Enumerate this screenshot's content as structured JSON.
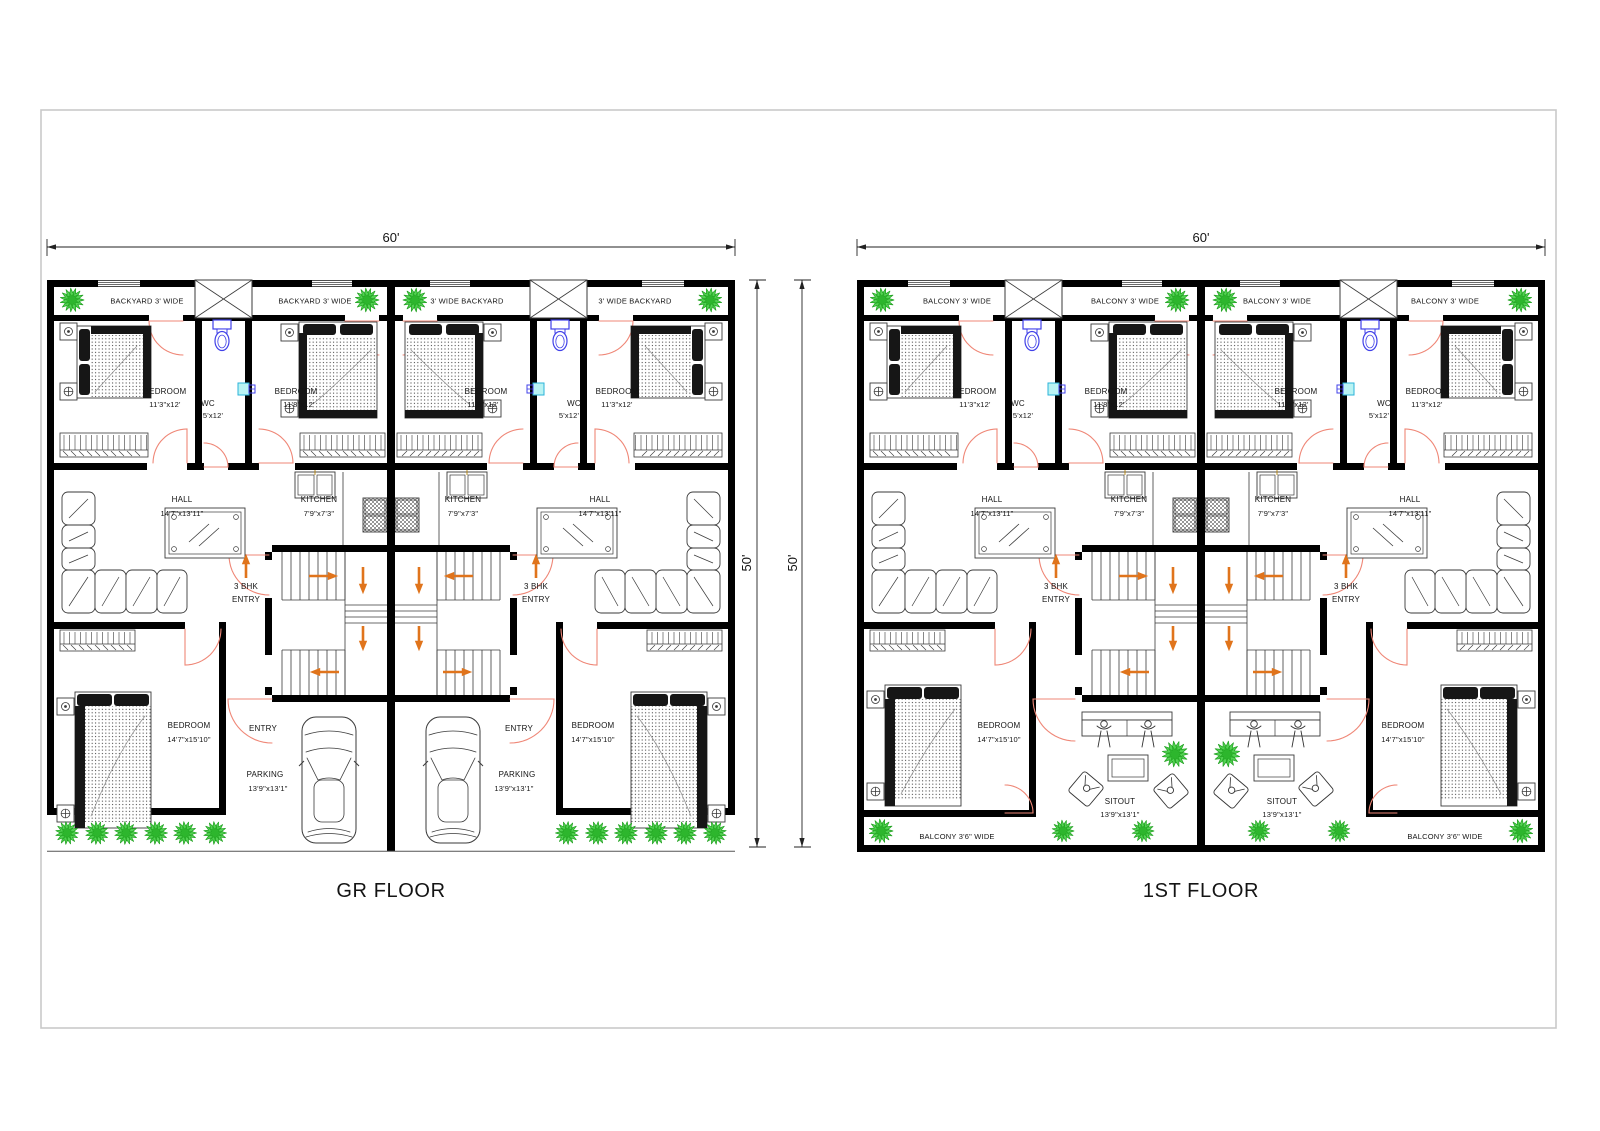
{
  "page": {
    "bg": "#ffffff",
    "frame_color": "#c9c9c9"
  },
  "colors": {
    "wall": "#000000",
    "line": "#3a3a3a",
    "door": "#ef8777",
    "arrow": "#e0741c",
    "plant": "#53d253",
    "plant_dark": "#2db62d",
    "plant_stroke": "#1fa01f",
    "toilet": "#4040e8",
    "basin_fill": "#b9f3f3",
    "basin_stroke": "#2bb3d9",
    "dim": "#222222",
    "dark_fill": "#161616"
  },
  "dimensions": {
    "width_label": "60'",
    "height_label": "50'"
  },
  "rooms": {
    "bedroom": "BEDROOM",
    "bedroom_front_size": "11'3\"x12'",
    "bedroom_mid_size": "11'8\"x12'",
    "bedroom_back_size": "14'7\"x15'10\"",
    "wc": "WC",
    "wc_size": "5'x12'",
    "hall": "HALL",
    "hall_size": "14'7\"x13'11\"",
    "kitchen": "KITCHEN",
    "kitchen_size": "7'9\"x7'3\"",
    "entry_3bhk_line1": "3 BHK",
    "entry_3bhk_line2": "ENTRY",
    "entry": "ENTRY",
    "parking": "PARKING",
    "parking_size": "13'9\"x13'1\"",
    "sitout": "SITOUT",
    "sitout_size": "13'9\"x13'1\""
  },
  "floors": [
    {
      "id": "gr",
      "type": "ground",
      "title": "GR FLOOR",
      "strip_labels": [
        "BACKYARD 3' WIDE",
        "BACKYARD 3' WIDE",
        "3' WIDE BACKYARD",
        "3' WIDE BACKYARD"
      ],
      "bottom_label": ""
    },
    {
      "id": "first",
      "type": "first",
      "title": "1ST FLOOR",
      "strip_labels": [
        "BALCONY 3' WIDE",
        "BALCONY 3' WIDE",
        "BALCONY 3' WIDE",
        "BALCONY 3' WIDE"
      ],
      "bottom_label": "BALCONY 3'6\" WIDE"
    }
  ]
}
